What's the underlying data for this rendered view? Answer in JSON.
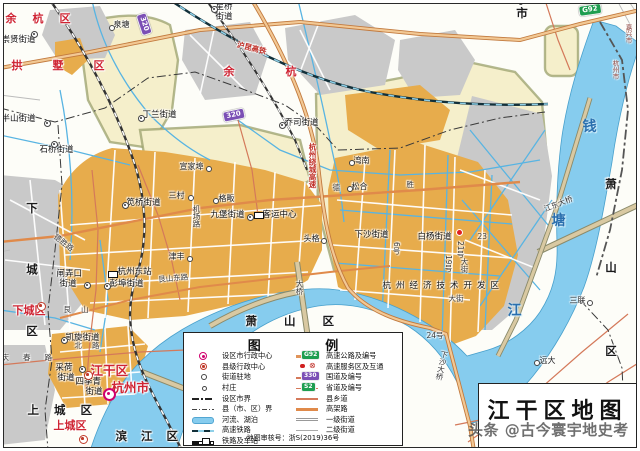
{
  "map_title": "江干区地图",
  "watermark": "头条 @古今寰宇地史考",
  "colors": {
    "district_label_red": "#cf2433",
    "water": "#86ccee",
    "built_up_main": "#e7ac4c",
    "built_up_other": "#c9c9c9",
    "farmland": "#f5efcb",
    "expressway": "#e0945a",
    "county_road": "#d4795a",
    "badge_expressway": "#1e9e50",
    "badge_national": "#7b4fb5",
    "city_center_marker": "#d0006e"
  },
  "legend": {
    "title": "图 例",
    "review": "地图审核号：浙S(2019)36号",
    "left": [
      {
        "icon": "city-center",
        "label": "设区市行政中心"
      },
      {
        "icon": "county-center",
        "label": "县级行政中心"
      },
      {
        "icon": "street-seat",
        "label": "街道驻地"
      },
      {
        "icon": "village",
        "label": "村庄"
      },
      {
        "icon": "city-boundary",
        "label": "设区市界"
      },
      {
        "icon": "county-boundary",
        "label": "县（市、区）界"
      },
      {
        "icon": "river-lake",
        "label": "河流、湖泊"
      },
      {
        "icon": "hsr",
        "label": "高速铁路"
      },
      {
        "icon": "railway-station",
        "label": "铁路及车站"
      }
    ],
    "right": [
      {
        "icon": "expressway",
        "badge": "G92",
        "badge_cls": "q-exp",
        "label": "高速公路及编号"
      },
      {
        "icon": "service-interchange",
        "label": "高速服务区及互通"
      },
      {
        "icon": "national-road",
        "badge": "330",
        "badge_cls": "q-nat",
        "label": "国道及编号"
      },
      {
        "icon": "provincial-road",
        "badge": "S2",
        "badge_cls": "q-prov",
        "label": "省道及编号"
      },
      {
        "icon": "county-road",
        "label": "县乡道"
      },
      {
        "icon": "elevated",
        "label": "高架路"
      },
      {
        "icon": "street-1",
        "label": "一级街道"
      },
      {
        "icon": "street-2",
        "label": "二级街道"
      }
    ]
  },
  "labels": [
    {
      "t": "余杭区",
      "x": 6,
      "y": 13,
      "c": "dr",
      "ls": 16
    },
    {
      "t": "拱墅区",
      "x": 12,
      "y": 60,
      "c": "dr",
      "ls": 30
    },
    {
      "t": "余杭",
      "x": 224,
      "y": 66,
      "c": "dr",
      "ls": 51
    },
    {
      "t": "下城区",
      "x": 26,
      "y": 202,
      "c": "db",
      "v": 1,
      "ls": 50
    },
    {
      "t": "下城区",
      "x": 13,
      "y": 305,
      "c": "dr"
    },
    {
      "t": "上城区",
      "x": 28,
      "y": 405,
      "c": "db",
      "ls": 15
    },
    {
      "t": "上城区",
      "x": 54,
      "y": 420,
      "c": "dr"
    },
    {
      "t": "江干区",
      "x": 91,
      "y": 365,
      "c": "drL"
    },
    {
      "t": "杭州市",
      "x": 112,
      "y": 382,
      "c": "drL"
    },
    {
      "t": "萧山区",
      "x": 246,
      "y": 316,
      "c": "db",
      "ls": 27
    },
    {
      "t": "萧山区",
      "x": 605,
      "y": 178,
      "c": "db",
      "v": 1,
      "ls": 72
    },
    {
      "t": "海宁市",
      "x": 516,
      "y": -20,
      "c": "db",
      "v": 1,
      "ls": 2
    },
    {
      "t": "嘉兴市",
      "x": 625,
      "y": 24,
      "c": "bd",
      "v": 1
    },
    {
      "t": "杭州市",
      "x": 612,
      "y": 60,
      "c": "bd",
      "v": 1
    },
    {
      "t": "滨江区",
      "x": 116,
      "y": 431,
      "c": "db",
      "ls": 14
    },
    {
      "t": "崇贤街道",
      "x": 2,
      "y": 36,
      "c": "pl"
    },
    {
      "t": "星桥",
      "x": 216,
      "y": 3,
      "c": "pl"
    },
    {
      "t": "街道",
      "x": 216,
      "y": 13,
      "c": "pl"
    },
    {
      "t": "泉塘",
      "x": 114,
      "y": 21,
      "c": "vi"
    },
    {
      "t": "半山街道",
      "x": 2,
      "y": 115,
      "c": "pl"
    },
    {
      "t": "石桥街道",
      "x": 40,
      "y": 146,
      "c": "pl"
    },
    {
      "t": "丁兰街道",
      "x": 143,
      "y": 111,
      "c": "pl"
    },
    {
      "t": "乔司街道",
      "x": 285,
      "y": 119,
      "c": "pl"
    },
    {
      "t": "笕桥街道",
      "x": 127,
      "y": 199,
      "c": "pl"
    },
    {
      "t": "宣家埠",
      "x": 180,
      "y": 163,
      "c": "vi"
    },
    {
      "t": "三村",
      "x": 169,
      "y": 192,
      "c": "vi"
    },
    {
      "t": "格畈",
      "x": 219,
      "y": 195,
      "c": "vi"
    },
    {
      "t": "九堡街道",
      "x": 211,
      "y": 211,
      "c": "pl"
    },
    {
      "t": "客运中心",
      "x": 263,
      "y": 211,
      "c": "pl"
    },
    {
      "t": "津丰",
      "x": 169,
      "y": 253,
      "c": "vi"
    },
    {
      "t": "湾南",
      "x": 354,
      "y": 157,
      "c": "vi"
    },
    {
      "t": "松合",
      "x": 352,
      "y": 183,
      "c": "vi"
    },
    {
      "t": "头格",
      "x": 304,
      "y": 235,
      "c": "vi"
    },
    {
      "t": "下沙街道",
      "x": 355,
      "y": 231,
      "c": "pl"
    },
    {
      "t": "白杨街道",
      "x": 418,
      "y": 233,
      "c": "pl"
    },
    {
      "t": "杭州东站",
      "x": 118,
      "y": 268,
      "c": "pl"
    },
    {
      "t": "彭埠街道",
      "x": 110,
      "y": 280,
      "c": "pl"
    },
    {
      "t": "闸弄口",
      "x": 57,
      "y": 270,
      "c": "pl"
    },
    {
      "t": "街道",
      "x": 60,
      "y": 280,
      "c": "pl"
    },
    {
      "t": "凯旋街道",
      "x": 66,
      "y": 334,
      "c": "pl"
    },
    {
      "t": "采荷",
      "x": 56,
      "y": 364,
      "c": "pl"
    },
    {
      "t": "街道",
      "x": 58,
      "y": 374,
      "c": "pl"
    },
    {
      "t": "四季青",
      "x": 76,
      "y": 378,
      "c": "pl"
    },
    {
      "t": "街道",
      "x": 86,
      "y": 388,
      "c": "pl"
    },
    {
      "t": "三联",
      "x": 570,
      "y": 297,
      "c": "vi"
    },
    {
      "t": "远大",
      "x": 540,
      "y": 357,
      "c": "vi"
    },
    {
      "t": "杭州经济技术开发区",
      "x": 383,
      "y": 282,
      "c": "pl",
      "ls": 5
    },
    {
      "t": "沪昆高铁",
      "x": 238,
      "y": 41,
      "c": "rr",
      "r": 14
    },
    {
      "t": "杭州绕城高速",
      "x": 309,
      "y": 143,
      "c": "rr",
      "v": 1
    },
    {
      "t": "德",
      "x": 333,
      "y": 184,
      "c": "rd"
    },
    {
      "t": "胜",
      "x": 407,
      "y": 181,
      "c": "rd"
    },
    {
      "t": "德胜路",
      "x": 57,
      "y": 233,
      "c": "rd",
      "r": 38
    },
    {
      "t": "北路",
      "x": 75,
      "y": 342,
      "c": "rd",
      "ls": 10
    },
    {
      "t": "庆春路",
      "x": 2,
      "y": 354,
      "c": "rd",
      "ls": 14
    },
    {
      "t": "艮山",
      "x": 64,
      "y": 306,
      "c": "rd",
      "ls": 10
    },
    {
      "t": "艮山东路",
      "x": 158,
      "y": 276,
      "c": "rd",
      "r": -5
    },
    {
      "t": "机场路",
      "x": 193,
      "y": 205,
      "c": "rd",
      "v": 1
    },
    {
      "t": "钱",
      "x": 583,
      "y": 120,
      "c": "wt"
    },
    {
      "t": "塘",
      "x": 552,
      "y": 214,
      "c": "wt"
    },
    {
      "t": "江",
      "x": 508,
      "y": 304,
      "c": "wt"
    },
    {
      "t": "下沙大桥",
      "x": 441,
      "y": 350,
      "c": "rd",
      "v": 1,
      "r": 12
    },
    {
      "t": "江东大桥",
      "x": 543,
      "y": 206,
      "c": "rd",
      "r": -21
    },
    {
      "t": "大桥",
      "x": 296,
      "y": 280,
      "c": "rd",
      "v": 1
    },
    {
      "t": "6号",
      "x": 393,
      "y": 242,
      "c": "rd",
      "v": 1
    },
    {
      "t": "21号",
      "x": 457,
      "y": 241,
      "c": "rd",
      "v": 1
    },
    {
      "t": "19号",
      "x": 445,
      "y": 255,
      "c": "rd",
      "v": 1
    },
    {
      "t": "23",
      "x": 478,
      "y": 233,
      "c": "rd"
    },
    {
      "t": "24号",
      "x": 427,
      "y": 332,
      "c": "rd"
    },
    {
      "t": "大街",
      "x": 449,
      "y": 295,
      "c": "rd"
    },
    {
      "t": "大街",
      "x": 461,
      "y": 258,
      "c": "rd",
      "v": 1
    }
  ],
  "markers": [
    {
      "m": "sub",
      "x": 31,
      "y": 31
    },
    {
      "m": "sub",
      "x": 211,
      "y": 6
    },
    {
      "m": "vlg",
      "x": 109,
      "y": 25
    },
    {
      "m": "sub",
      "x": 44,
      "y": 120
    },
    {
      "m": "sub",
      "x": 51,
      "y": 141
    },
    {
      "m": "sub",
      "x": 138,
      "y": 115
    },
    {
      "m": "sub",
      "x": 279,
      "y": 122
    },
    {
      "m": "sub",
      "x": 122,
      "y": 202
    },
    {
      "m": "vlg",
      "x": 206,
      "y": 166
    },
    {
      "m": "vlg",
      "x": 188,
      "y": 195
    },
    {
      "m": "vlg",
      "x": 213,
      "y": 198
    },
    {
      "m": "sub",
      "x": 247,
      "y": 214
    },
    {
      "m": "sta",
      "x": 254,
      "y": 212
    },
    {
      "m": "vlg",
      "x": 187,
      "y": 256
    },
    {
      "m": "vlg",
      "x": 349,
      "y": 160
    },
    {
      "m": "vlg",
      "x": 347,
      "y": 186
    },
    {
      "m": "vlg",
      "x": 321,
      "y": 238
    },
    {
      "m": "dot",
      "x": 456,
      "y": 229
    },
    {
      "m": "sta",
      "x": 108,
      "y": 271
    },
    {
      "m": "sub",
      "x": 104,
      "y": 283
    },
    {
      "m": "sub",
      "x": 84,
      "y": 282
    },
    {
      "m": "sub",
      "x": 61,
      "y": 337
    },
    {
      "m": "sub",
      "x": 79,
      "y": 366
    },
    {
      "m": "vlg",
      "x": 587,
      "y": 300
    },
    {
      "m": "vlg",
      "x": 534,
      "y": 360
    },
    {
      "m": "city",
      "x": 103,
      "y": 388
    },
    {
      "m": "county",
      "x": 37,
      "y": 302
    },
    {
      "m": "county",
      "x": 79,
      "y": 435
    },
    {
      "m": "county",
      "x": 84,
      "y": 371
    }
  ],
  "badges": [
    {
      "b": "G92",
      "cls": "bg-exp",
      "x": 578,
      "y": 6,
      "r": -8
    },
    {
      "b": "320",
      "cls": "bg-nat",
      "x": 146,
      "y": 12,
      "r": 72
    },
    {
      "b": "320",
      "cls": "bg-nat",
      "x": 222,
      "y": 112,
      "r": -12
    }
  ]
}
